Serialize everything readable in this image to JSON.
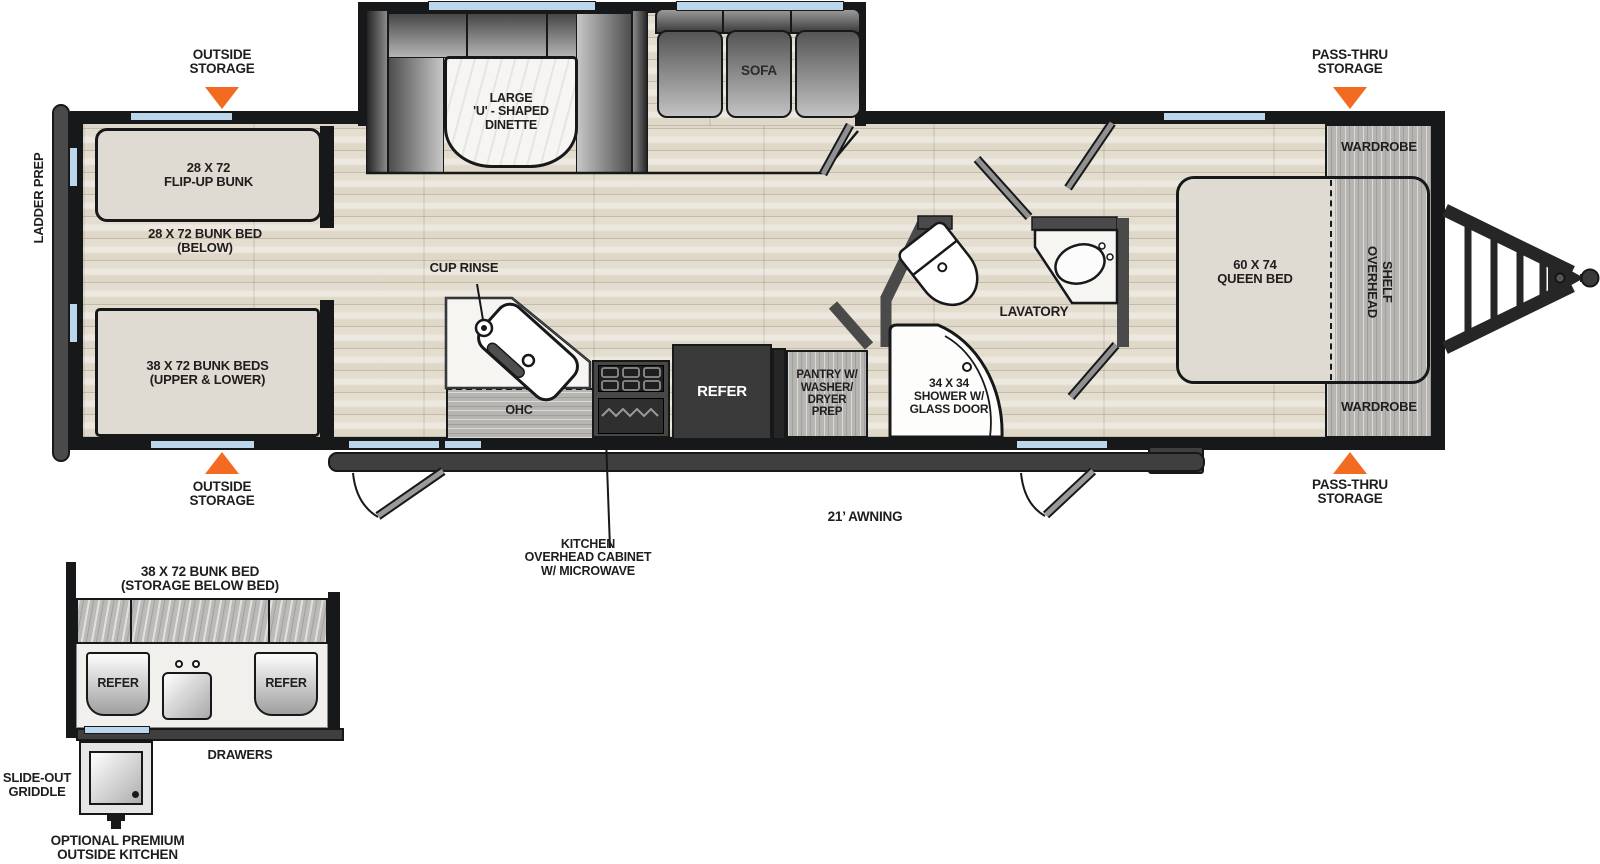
{
  "colors": {
    "accent_orange": "#F26B21",
    "window_blue": "#BCD7EC",
    "wall_black": "#17181A",
    "frame_gray": "#3F3F3F",
    "floor_beige": "#E8E3D7",
    "cushion_beige": "#DFDBD2"
  },
  "floorplan": {
    "exterior": {
      "ladder_prep": "LADDER PREP",
      "awning_label": "21’ AWNING",
      "outside_storage_top": "OUTSIDE\nSTORAGE",
      "outside_storage_bottom": "OUTSIDE\nSTORAGE",
      "pass_thru_storage_top": "PASS-THRU\nSTORAGE",
      "pass_thru_storage_bottom": "PASS-THRU\nSTORAGE"
    },
    "bunk_room": {
      "flip_up_bunk": "28 X 72\nFLIP-UP BUNK",
      "bunk_below": "28 X 72 BUNK BED\n(BELOW)",
      "bunk_beds": "38 X 72 BUNK BEDS\n(UPPER & LOWER)"
    },
    "living": {
      "dinette": "LARGE\n'U' - SHAPED\nDINETTE",
      "sofa": "SOFA"
    },
    "kitchen": {
      "cup_rinse": "CUP RINSE",
      "ohc": "OHC",
      "refer": "REFER",
      "pantry": "PANTRY W/\nWASHER/\nDRYER\nPREP",
      "overhead_cabinet": "KITCHEN\nOVERHEAD CABINET\nW/ MICROWAVE"
    },
    "bath": {
      "shower": "34 X 34\nSHOWER W/\nGLASS DOOR",
      "lavatory": "LAVATORY"
    },
    "bedroom": {
      "queen_bed": "60 X 74\nQUEEN BED",
      "overhead_shelf": "OVERHEAD\nSHELF",
      "wardrobe_top": "WARDROBE",
      "wardrobe_bottom": "WARDROBE"
    }
  },
  "outside_kitchen": {
    "title": "38 X 72 BUNK BED\n(STORAGE BELOW BED)",
    "refer_left": "REFER",
    "refer_right": "REFER",
    "drawers": "DRAWERS",
    "griddle": "SLIDE-OUT\nGRIDDLE",
    "caption": "OPTIONAL PREMIUM\nOUTSIDE KITCHEN"
  }
}
